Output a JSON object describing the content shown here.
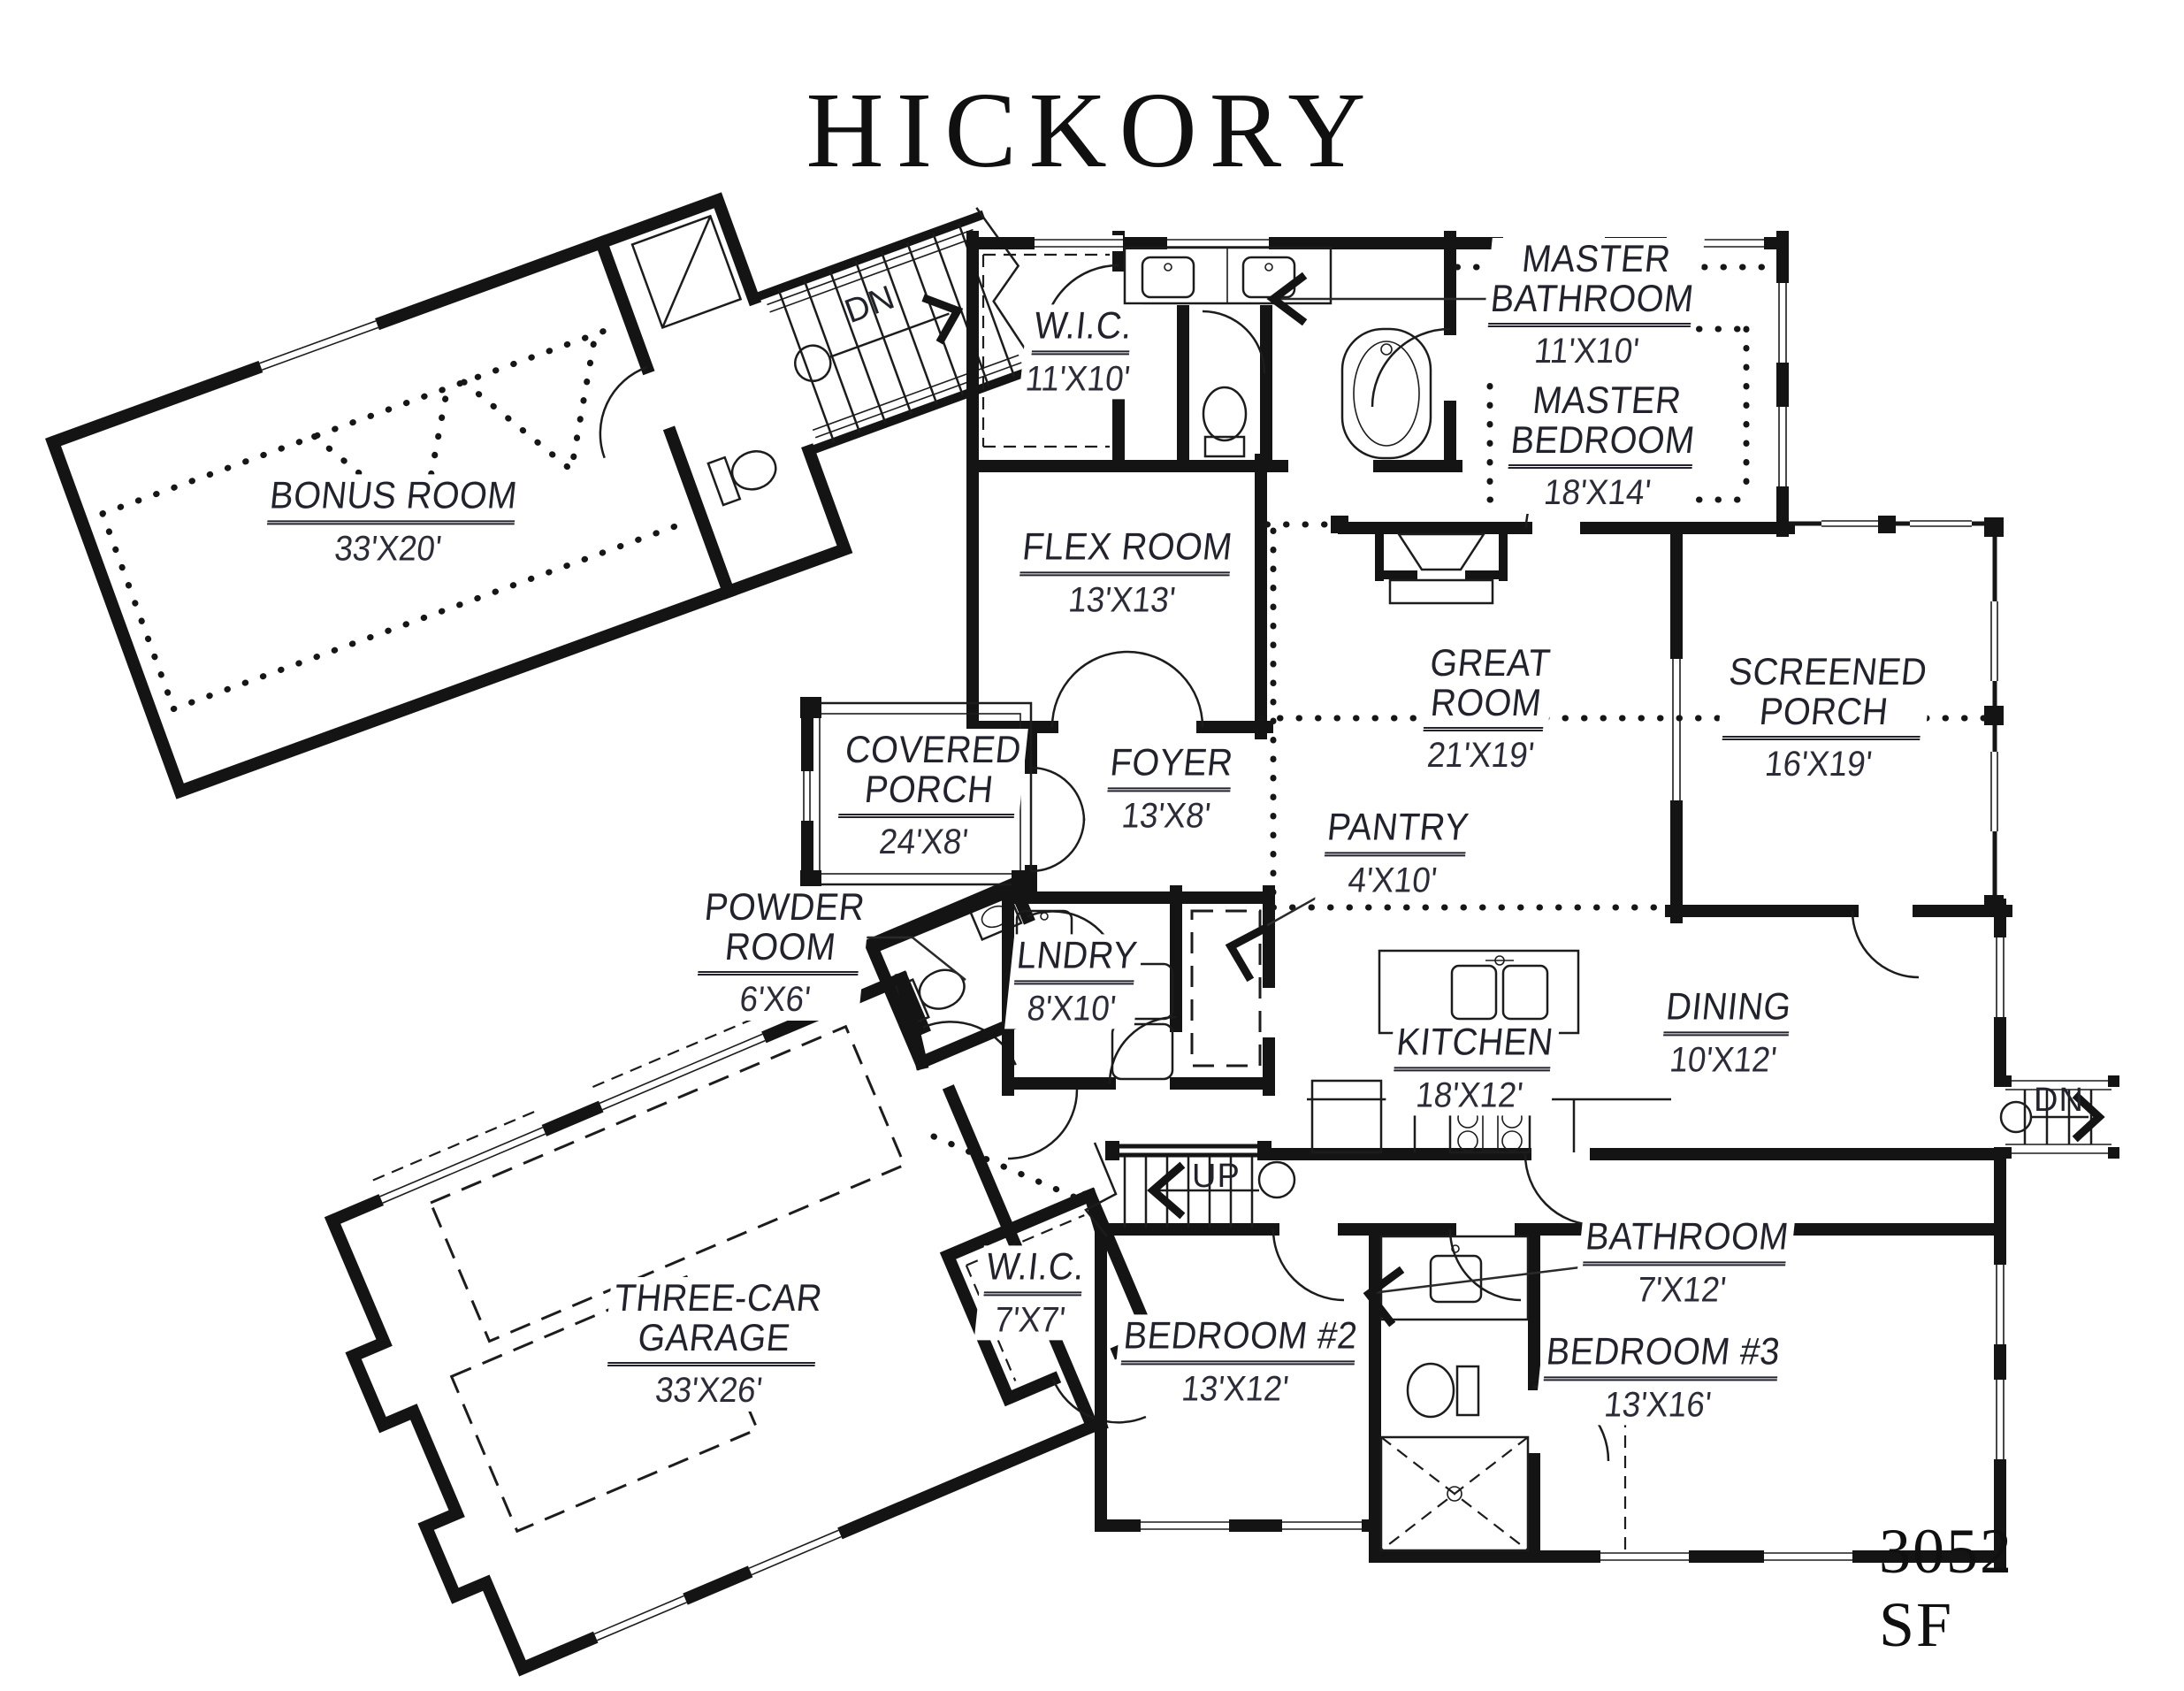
{
  "title": "HICKORY",
  "area_label": "3052 SF",
  "rooms": {
    "bonus": {
      "line1": "BONUS ROOM",
      "line2": null,
      "dims": "33'X20'"
    },
    "wic_master": {
      "line1": "W.I.C.",
      "line2": null,
      "dims": "11'X10'"
    },
    "master_bath": {
      "line1": "MASTER",
      "line2": "BATHROOM",
      "dims": "11'X10'"
    },
    "master_bed": {
      "line1": "MASTER",
      "line2": "BEDROOM",
      "dims": "18'X14'"
    },
    "flex": {
      "line1": "FLEX ROOM",
      "line2": null,
      "dims": "13'X13'"
    },
    "great": {
      "line1": "GREAT",
      "line2": "ROOM",
      "dims": "21'X19'"
    },
    "screened": {
      "line1": "SCREENED",
      "line2": "PORCH",
      "dims": "16'X19'"
    },
    "covered": {
      "line1": "COVERED",
      "line2": "PORCH",
      "dims": "24'X8'"
    },
    "foyer": {
      "line1": "FOYER",
      "line2": null,
      "dims": "13'X8'"
    },
    "pantry": {
      "line1": "PANTRY",
      "line2": null,
      "dims": "4'X10'"
    },
    "powder": {
      "line1": "POWDER",
      "line2": "ROOM",
      "dims": "6'X6'"
    },
    "laundry": {
      "line1": "LNDRY",
      "line2": null,
      "dims": "8'X10'"
    },
    "kitchen": {
      "line1": "KITCHEN",
      "line2": null,
      "dims": "18'X12'"
    },
    "dining": {
      "line1": "DINING",
      "line2": null,
      "dims": "10'X12'"
    },
    "garage": {
      "line1": "THREE-CAR",
      "line2": "GARAGE",
      "dims": "33'X26'"
    },
    "wic2": {
      "line1": "W.I.C.",
      "line2": null,
      "dims": "7'X7'"
    },
    "bed2": {
      "line1": "BEDROOM #2",
      "line2": null,
      "dims": "13'X12'"
    },
    "bath2": {
      "line1": "BATHROOM",
      "line2": null,
      "dims": "7'X12'"
    },
    "bed3": {
      "line1": "BEDROOM #3",
      "line2": null,
      "dims": "13'X16'"
    }
  },
  "stairs": {
    "bonus_dn": "DN",
    "up": "UP",
    "deck_dn": "DN"
  }
}
